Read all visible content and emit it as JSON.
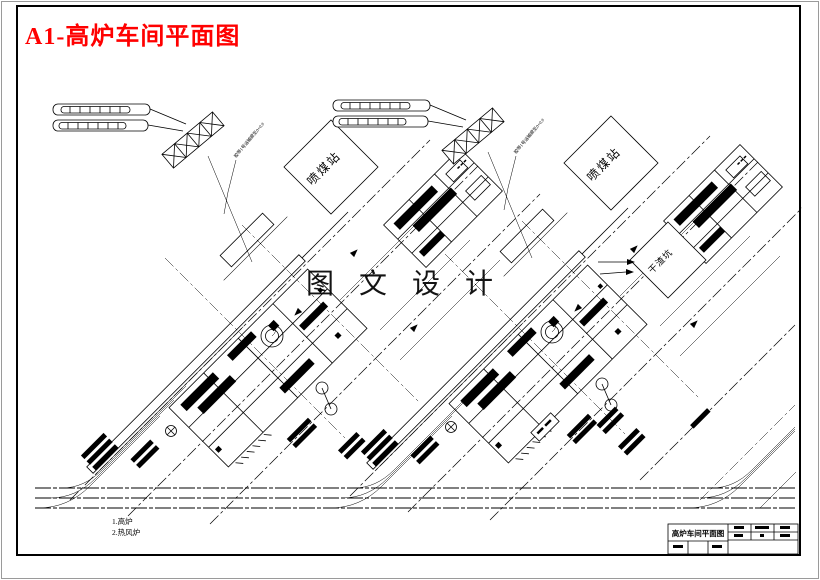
{
  "window": {
    "background": "#ffffff",
    "outer_border_color": "#9a9a9a",
    "inner_border_color": "#000000",
    "line_color": "#000000"
  },
  "header": {
    "drawing_title": "A1-高炉车间平面图",
    "title_color": "#ff0000"
  },
  "watermark": {
    "text": "图 文 设 计"
  },
  "plan_labels": {
    "coal_injection_station": "喷煤站",
    "dry_slag_pit": "干渣坑",
    "conveyor_annotation": "胶带1号运输廊至0+0.0"
  },
  "legend": {
    "items": [
      {
        "label": "1.高炉"
      },
      {
        "label": "2.热风炉"
      }
    ]
  },
  "title_block": {
    "drawing_name": "高炉车间平面图"
  }
}
